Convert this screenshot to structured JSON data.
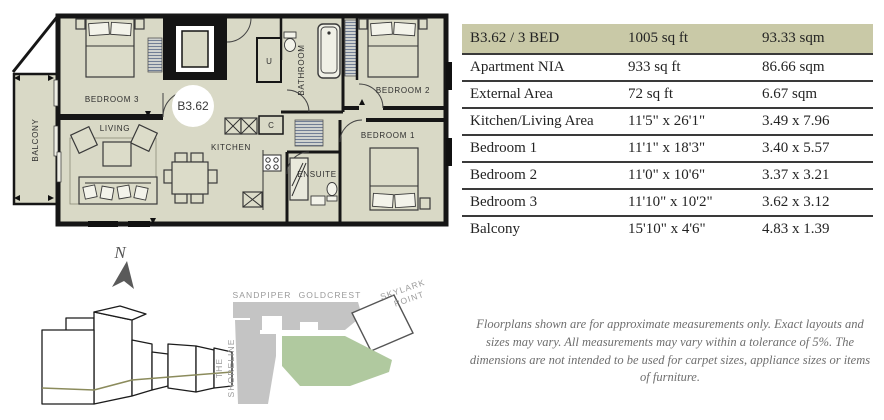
{
  "unit": {
    "id": "B3.62",
    "type": "3 BED"
  },
  "floorplan": {
    "unit_label": "B3.62",
    "compass": "N",
    "rooms": {
      "bedroom3": "BEDROOM 3",
      "living": "LIVING",
      "kitchen": "KITCHEN",
      "bathroom": "BATHROOM",
      "bedroom2": "BEDROOM 2",
      "bedroom1": "BEDROOM 1",
      "ensuite": "ENSUITE",
      "balcony": "BALCONY",
      "utility": "U",
      "cupboard": "C"
    }
  },
  "site_plan": {
    "buildings": {
      "sandpiper": "SANDPIPER",
      "goldcrest": "GOLDCREST",
      "skylark_line1": "SKYLARK",
      "skylark_line2": "POINT",
      "shoreline_line1": "THE",
      "shoreline_line2": "SHORELINE"
    }
  },
  "table": {
    "rows": [
      {
        "label": "B3.62 / 3 BED",
        "imperial": "1005 sq ft",
        "metric": "93.33 sqm"
      },
      {
        "label": "Apartment NIA",
        "imperial": "933 sq ft",
        "metric": "86.66 sqm"
      },
      {
        "label": "External Area",
        "imperial": "72 sq ft",
        "metric": "6.67 sqm"
      },
      {
        "label": "Kitchen/Living Area",
        "imperial": "11'5\" x 26'1\"",
        "metric": "3.49 x 7.96"
      },
      {
        "label": "Bedroom 1",
        "imperial": "11'1\" x 18'3\"",
        "metric": "3.40 x 5.57"
      },
      {
        "label": "Bedroom 2",
        "imperial": "11'0\" x 10'6\"",
        "metric": "3.37 x 3.21"
      },
      {
        "label": "Bedroom 3",
        "imperial": "11'10\" x 10'2\"",
        "metric": "3.62 x 3.12"
      },
      {
        "label": "Balcony",
        "imperial": "15'10\" x 4'6\"",
        "metric": "4.83 x 1.39"
      }
    ]
  },
  "disclaimer": "Floorplans shown are for approximate measurements only. Exact layouts and sizes may vary. All measurements may vary within a tolerance of 5%. The dimensions are not intended to be used for carpet sizes, appliance sizes or items of furniture.",
  "colors": {
    "room_fill": "#d9d9c6",
    "wall": "#161616",
    "table_header_bg": "#c9c9a7",
    "lawn_green": "#b0c99f",
    "site_gray": "#c4c4c4",
    "floor_line_olive": "#8b8b5c"
  }
}
